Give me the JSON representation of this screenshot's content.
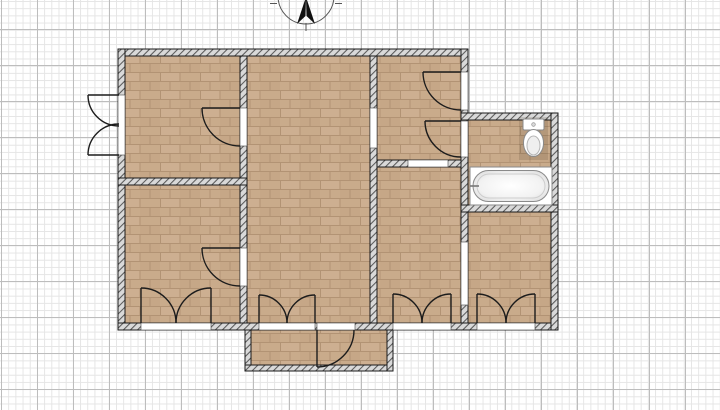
{
  "palette": {
    "background": "#ffffff",
    "grid_minor": "#e5e5e5",
    "grid_major": "#bdbdbd",
    "wall_fill": "#d9d9d9",
    "wall_hatch": "#5a5a5a",
    "wall_outline": "#1a1a1a",
    "floor_brick_a": "#c9ab8b",
    "floor_brick_b": "#cfb295",
    "floor_brick_c": "#c2a382",
    "floor_grout": "#b29374",
    "door_stroke": "#1c1c1c",
    "opening_fill": "#ffffff",
    "opening_edge": "#444444",
    "fixture_fill": "#ffffff",
    "fixture_stroke": "#8a8a8a",
    "compass_stroke": "#555555",
    "compass_needle": "#111111"
  },
  "grid": {
    "minor_step": 7.2,
    "major_step": 36
  },
  "floorplan": {
    "rooms": [
      {
        "name": "room-top-left-floor",
        "rect": [
          125,
          56,
          115,
          122
        ]
      },
      {
        "name": "room-bottom-left-floor",
        "rect": [
          125,
          185,
          115,
          138
        ]
      },
      {
        "name": "room-center-floor",
        "rect": [
          247,
          56,
          123,
          267
        ]
      },
      {
        "name": "hallway-top-right-floor",
        "rect": [
          377,
          56,
          84,
          104
        ]
      },
      {
        "name": "room-middle-right-floor",
        "rect": [
          377,
          167,
          84,
          156
        ]
      },
      {
        "name": "bathroom-floor",
        "rect": [
          468,
          120,
          83,
          85
        ]
      },
      {
        "name": "room-bottom-right-floor",
        "rect": [
          468,
          212,
          83,
          111
        ]
      },
      {
        "name": "porch-floor",
        "rect": [
          251,
          330,
          136,
          35
        ]
      }
    ],
    "walls": [
      {
        "name": "wall-exterior-top",
        "rect": [
          118,
          49,
          350,
          7
        ]
      },
      {
        "name": "wall-exterior-left",
        "rect": [
          118,
          49,
          7,
          281
        ]
      },
      {
        "name": "wall-exterior-bottom",
        "rect": [
          118,
          323,
          440,
          7
        ]
      },
      {
        "name": "wall-right-main",
        "rect": [
          461,
          49,
          7,
          274
        ]
      },
      {
        "name": "wall-bathroom-top",
        "rect": [
          461,
          113,
          97,
          7
        ]
      },
      {
        "name": "wall-bathroom-right",
        "rect": [
          551,
          113,
          7,
          217
        ]
      },
      {
        "name": "wall-bathroom-divider",
        "rect": [
          461,
          205,
          97,
          7
        ]
      },
      {
        "name": "wall-interior-left",
        "rect": [
          240,
          56,
          7,
          267
        ]
      },
      {
        "name": "wall-interior-right",
        "rect": [
          370,
          56,
          7,
          267
        ]
      },
      {
        "name": "wall-hallway-divider",
        "rect": [
          377,
          160,
          84,
          7
        ]
      },
      {
        "name": "wall-left-rooms-divider",
        "rect": [
          118,
          178,
          129,
          7
        ]
      },
      {
        "name": "wall-porch-left",
        "rect": [
          245,
          330,
          6,
          41
        ]
      },
      {
        "name": "wall-porch-bottom",
        "rect": [
          245,
          365,
          148,
          6
        ]
      },
      {
        "name": "wall-porch-right",
        "rect": [
          387,
          330,
          6,
          41
        ]
      }
    ],
    "openings": [
      {
        "name": "opening-exterior-left-door",
        "rect": [
          118,
          95,
          7,
          60
        ]
      },
      {
        "name": "opening-room-top-left",
        "rect": [
          240,
          108,
          7,
          38
        ]
      },
      {
        "name": "opening-room-bottom-left",
        "rect": [
          240,
          248,
          7,
          38
        ]
      },
      {
        "name": "passage-center-hallway",
        "rect": [
          370,
          108,
          7,
          40
        ]
      },
      {
        "name": "opening-entry-door",
        "rect": [
          461,
          72,
          7,
          38
        ]
      },
      {
        "name": "opening-bathroom-door",
        "rect": [
          461,
          121,
          7,
          36
        ]
      },
      {
        "name": "passage-middle-to-bottom-right",
        "rect": [
          461,
          242,
          7,
          63
        ]
      },
      {
        "name": "passage-hallway-to-middle",
        "rect": [
          408,
          160,
          40,
          7
        ]
      },
      {
        "name": "opening-double-door-left",
        "rect": [
          141,
          323,
          70,
          7
        ]
      },
      {
        "name": "opening-double-door-center",
        "rect": [
          259,
          323,
          56,
          7
        ]
      },
      {
        "name": "opening-porch-door",
        "rect": [
          317,
          323,
          38,
          7
        ]
      },
      {
        "name": "opening-double-door-midright",
        "rect": [
          393,
          323,
          58,
          7
        ]
      },
      {
        "name": "opening-double-door-botright",
        "rect": [
          477,
          323,
          58,
          7
        ]
      }
    ],
    "doors": [
      {
        "name": "door-exterior-left-top",
        "leaf": [
          119,
          95,
          88,
          95
        ],
        "arc": [
          88,
          95,
          31,
          0,
          119,
          126
        ]
      },
      {
        "name": "door-exterior-left-bottom",
        "leaf": [
          119,
          155,
          88,
          155
        ],
        "arc": [
          88,
          155,
          31,
          1,
          119,
          124
        ]
      },
      {
        "name": "door-room-top-left",
        "leaf": [
          240,
          108,
          202,
          108
        ],
        "arc": [
          202,
          108,
          38,
          0,
          240,
          146
        ]
      },
      {
        "name": "door-room-bottom-left",
        "leaf": [
          240,
          248,
          202,
          248
        ],
        "arc": [
          202,
          248,
          38,
          0,
          240,
          286
        ]
      },
      {
        "name": "door-entry",
        "leaf": [
          461,
          72,
          423,
          72
        ],
        "arc": [
          423,
          72,
          38,
          0,
          461,
          110
        ]
      },
      {
        "name": "door-bathroom",
        "leaf": [
          461,
          121,
          425,
          121
        ],
        "arc": [
          425,
          121,
          36,
          0,
          461,
          157
        ]
      },
      {
        "name": "door-porch",
        "leaf": [
          317,
          330,
          317,
          367
        ],
        "arc": [
          317,
          367,
          37,
          0,
          354,
          330
        ]
      },
      {
        "name": "door-double-left-a",
        "leaf": [
          141,
          323,
          141,
          288
        ],
        "arc": [
          141,
          288,
          35,
          1,
          176,
          323
        ]
      },
      {
        "name": "door-double-left-b",
        "leaf": [
          211,
          323,
          211,
          288
        ],
        "arc": [
          211,
          288,
          35,
          0,
          176,
          323
        ]
      },
      {
        "name": "door-double-center-a",
        "leaf": [
          259,
          323,
          259,
          295
        ],
        "arc": [
          259,
          295,
          28,
          1,
          287,
          323
        ]
      },
      {
        "name": "door-double-center-b",
        "leaf": [
          315,
          323,
          315,
          295
        ],
        "arc": [
          315,
          295,
          28,
          0,
          287,
          323
        ]
      },
      {
        "name": "door-double-midright-a",
        "leaf": [
          393,
          323,
          393,
          294
        ],
        "arc": [
          393,
          294,
          29,
          1,
          422,
          323
        ]
      },
      {
        "name": "door-double-midright-b",
        "leaf": [
          451,
          323,
          451,
          294
        ],
        "arc": [
          451,
          294,
          29,
          0,
          422,
          323
        ]
      },
      {
        "name": "door-double-botright-a",
        "leaf": [
          477,
          323,
          477,
          294
        ],
        "arc": [
          477,
          294,
          29,
          1,
          506,
          323
        ]
      },
      {
        "name": "door-double-botright-b",
        "leaf": [
          535,
          323,
          535,
          294
        ],
        "arc": [
          535,
          294,
          29,
          0,
          506,
          323
        ]
      }
    ],
    "fixtures": {
      "toilet": {
        "base": [
          519,
          117,
          29,
          43
        ],
        "tank": [
          523,
          119,
          21,
          11
        ],
        "button": [
          533.5,
          124.5,
          1.8
        ],
        "bowl_outer": [
          533.5,
          143,
          10,
          13.5
        ],
        "bowl_inner": [
          533.5,
          145.5,
          6.5,
          9.5
        ]
      },
      "bathtub": {
        "frame": [
          470,
          167,
          82,
          38
        ],
        "tub": [
          473,
          170.5,
          76,
          31,
          15.5
        ],
        "rim": [
          477,
          174,
          68,
          24,
          12
        ],
        "faucet": [
          470,
          186,
          479,
          186
        ]
      }
    }
  },
  "compass": {
    "circle": [
      306,
      -4,
      28
    ],
    "needle_left": "306,-3 297,24 305.5,16",
    "needle_right": "306,-3 315,24 306.5,16",
    "ticks": [
      [
        270,
        3.5,
        277,
        3.5
      ],
      [
        335,
        3.5,
        342,
        3.5
      ],
      [
        306,
        23,
        306,
        31
      ]
    ]
  }
}
